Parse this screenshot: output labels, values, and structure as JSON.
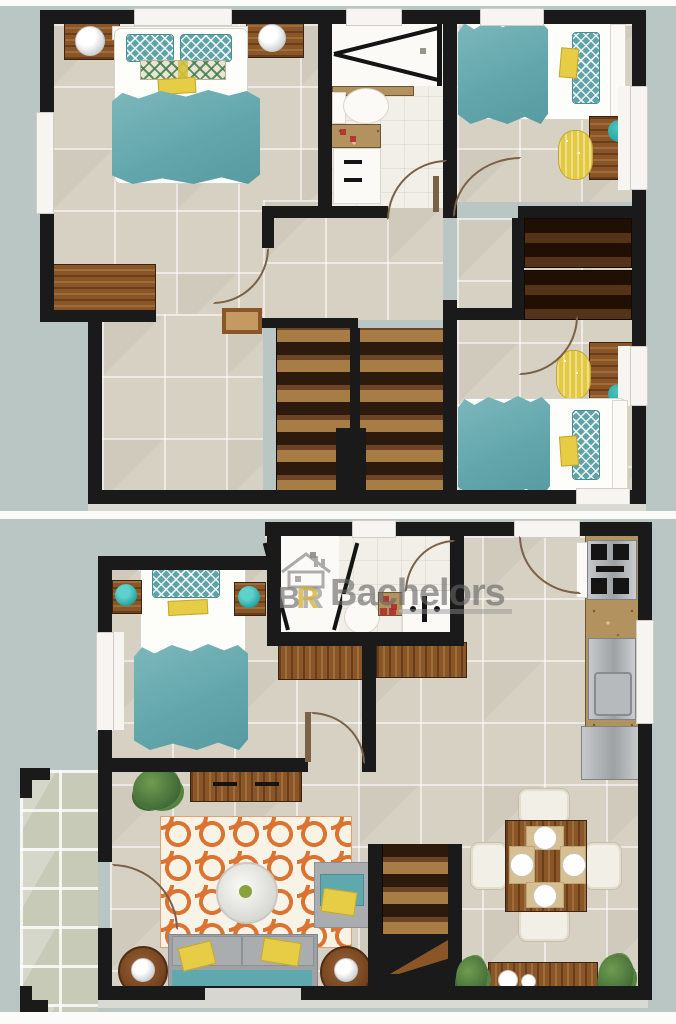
{
  "watermark": {
    "brand": "Bachelors",
    "logo_b": "B",
    "logo_r": "R"
  },
  "palette": {
    "background": "#b9c6c3",
    "wall": "#1a1a1a",
    "floor_tile": "#d7d1c3",
    "bath_tile": "#f1efe8",
    "porch_tile": "#c6cab7",
    "wood": "#8a5527",
    "wood_dark": "#3a2511",
    "teal": "#63a7ac",
    "teal_accent": "#21a09c",
    "yellow": "#e7cd46",
    "orange_rug": "#dc7331",
    "granite": "#b2935f",
    "stainless": "#c6c9cb",
    "sofa_grey": "#9da1a3",
    "logo_grey": "#787878",
    "logo_yellow": "#d5b23a",
    "red_accent": "#b22a2a"
  },
  "floors": [
    {
      "name": "upper-floor-plan",
      "rooms": [
        {
          "name": "bedroom-1",
          "furniture": [
            "double-bed",
            "teal-blanket",
            "two-pillows",
            "lumbar-pillow",
            "nightstand-left",
            "nightstand-right",
            "white-table-lamp",
            "white-table-lamp",
            "dresser"
          ]
        },
        {
          "name": "bathroom",
          "furniture": [
            "shower-with-glass-door",
            "toilet",
            "vanity-sink"
          ]
        },
        {
          "name": "bedroom-2",
          "furniture": [
            "single-bed",
            "desk",
            "yellow-stool",
            "teal-lamp"
          ]
        },
        {
          "name": "hallway",
          "furniture": [
            "small-table"
          ]
        },
        {
          "name": "closet",
          "furniture": [
            "wardrobe",
            "wardrobe"
          ]
        },
        {
          "name": "staircase",
          "furniture": [
            "u-shaped-stairs"
          ]
        },
        {
          "name": "bedroom-3",
          "furniture": [
            "single-bed",
            "desk",
            "yellow-stool",
            "teal-lamp"
          ]
        }
      ]
    },
    {
      "name": "ground-floor-plan",
      "rooms": [
        {
          "name": "bedroom",
          "furniture": [
            "single-bed",
            "nightstand-left",
            "nightstand-right",
            "teal-lamp",
            "teal-lamp",
            "cabinet"
          ]
        },
        {
          "name": "bathroom",
          "furniture": [
            "shower-with-glass-door",
            "toilet",
            "vanity-sink"
          ]
        },
        {
          "name": "hallway",
          "furniture": [
            "cabinet"
          ]
        },
        {
          "name": "kitchen",
          "furniture": [
            "gas-stove",
            "granite-counter",
            "sink",
            "refrigerator"
          ]
        },
        {
          "name": "living-room",
          "furniture": [
            "console-table",
            "potted-plant",
            "trellis-rug",
            "round-coffee-table",
            "armchair",
            "sofa",
            "yellow-throw-pillows",
            "side-table",
            "side-table",
            "table-lamp",
            "table-lamp"
          ]
        },
        {
          "name": "dining-room",
          "furniture": [
            "square-dining-table",
            "four-chairs",
            "four-place-settings",
            "sideboard",
            "vases",
            "potted-plant",
            "potted-plant"
          ]
        },
        {
          "name": "staircase",
          "furniture": [
            "stairs"
          ]
        },
        {
          "name": "porch",
          "furniture": []
        }
      ]
    }
  ]
}
